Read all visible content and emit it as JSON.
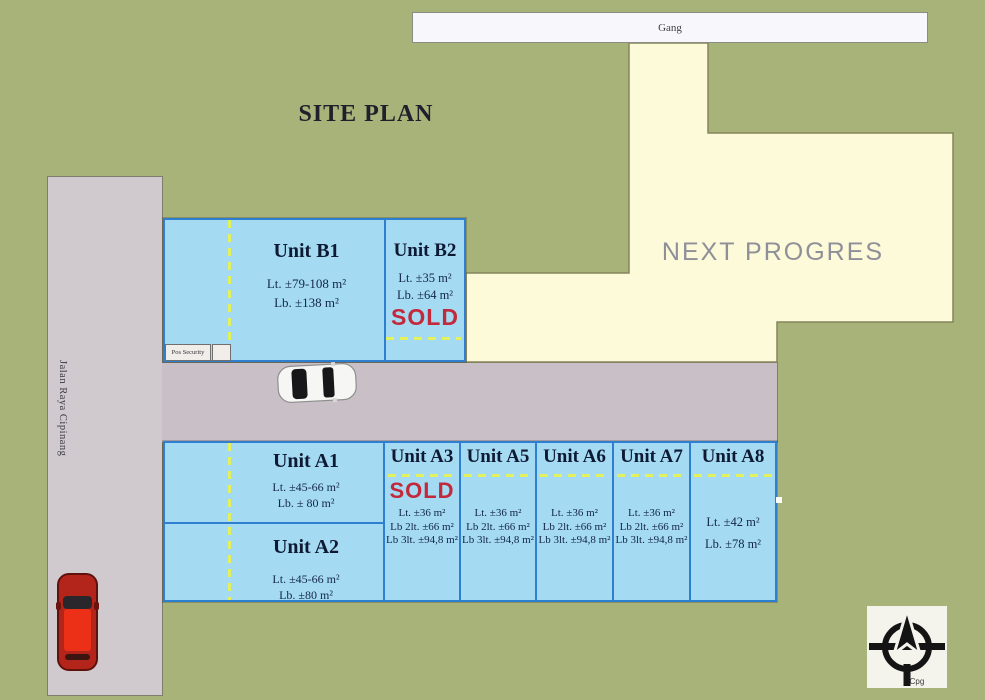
{
  "site": {
    "title": "SITE PLAN",
    "gang": "Gang",
    "street": "Jalan Raya Cipinang",
    "next_progress": "NEXT PROGRES",
    "pos_security": "Pos Security",
    "compass": "Cpg",
    "sold": "SOLD"
  },
  "colors": {
    "background_green": "#a8b37a",
    "road_gray": "#c8c0c6",
    "unit_fill": "#a5daf3",
    "unit_border": "#2e7fd0",
    "future_area_fill": "#fcfad8",
    "sold_red": "#c2293a",
    "dash_yellow": "#e3f25c",
    "gang_fill": "#f8f7fb"
  },
  "units": {
    "b1": {
      "name": "Unit B1",
      "lines": [
        "Lt. ±79-108 m²",
        "Lb. ±138 m²"
      ]
    },
    "b2": {
      "name": "Unit B2",
      "lines": [
        "Lt. ±35 m²",
        "Lb. ±64 m²"
      ],
      "sold": true
    },
    "a1": {
      "name": "Unit A1",
      "lines": [
        "Lt. ±45-66 m²",
        "Lb. ± 80 m²"
      ]
    },
    "a2": {
      "name": "Unit A2",
      "lines": [
        "Lt. ±45-66 m²",
        "Lb. ±80 m²"
      ]
    },
    "a3": {
      "name": "Unit A3",
      "lines": [
        "Lt. ±36 m²",
        "Lb 2lt. ±66 m²",
        "Lb 3lt. ±94,8 m²"
      ],
      "sold": true
    },
    "a5": {
      "name": "Unit A5",
      "lines": [
        "Lt. ±36 m²",
        "Lb 2lt. ±66 m²",
        "Lb 3lt. ±94,8 m²"
      ]
    },
    "a6": {
      "name": "Unit A6",
      "lines": [
        "Lt. ±36 m²",
        "Lb 2lt. ±66 m²",
        "Lb 3lt. ±94,8 m²"
      ]
    },
    "a7": {
      "name": "Unit A7",
      "lines": [
        "Lt. ±36 m²",
        "Lb 2lt. ±66 m²",
        "Lb 3lt. ±94,8 m²"
      ]
    },
    "a8": {
      "name": "Unit A8",
      "lines": [
        "Lt. ±42 m²",
        "Lb. ±78 m²"
      ]
    }
  }
}
